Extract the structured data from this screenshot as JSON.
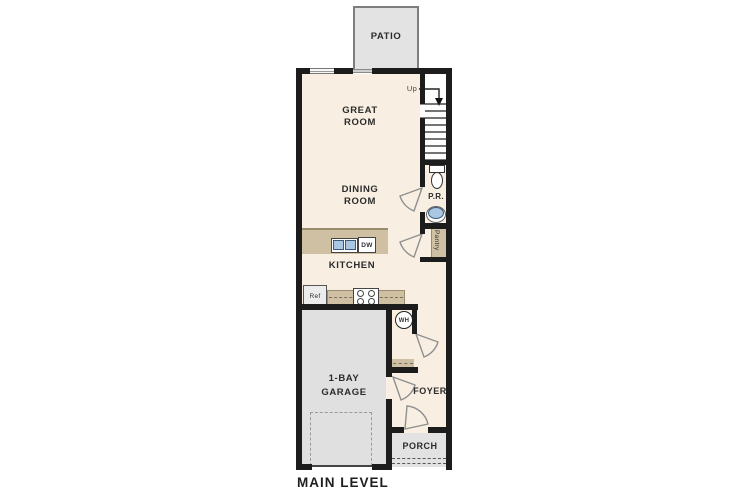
{
  "plan": {
    "title": "MAIN LEVEL",
    "rooms": {
      "patio": "PATIO",
      "great_room": "GREAT ROOM",
      "dining_room": "DINING ROOM",
      "kitchen": "KITCHEN",
      "powder_room": "P.R.",
      "pantry": "Pantry",
      "garage": "1-BAY GARAGE",
      "foyer": "FOYER",
      "porch": "PORCH"
    },
    "fixtures": {
      "refrigerator": "Ref",
      "dishwasher": "DW",
      "water_heater": "WH",
      "stairs_direction": "Up"
    },
    "colors": {
      "wall": "#1c1c1c",
      "floor": "#f8efe2",
      "concrete": "#e0e0e0",
      "counter": "#cfc0a4",
      "sink_blue": "#a9c6e2"
    }
  }
}
